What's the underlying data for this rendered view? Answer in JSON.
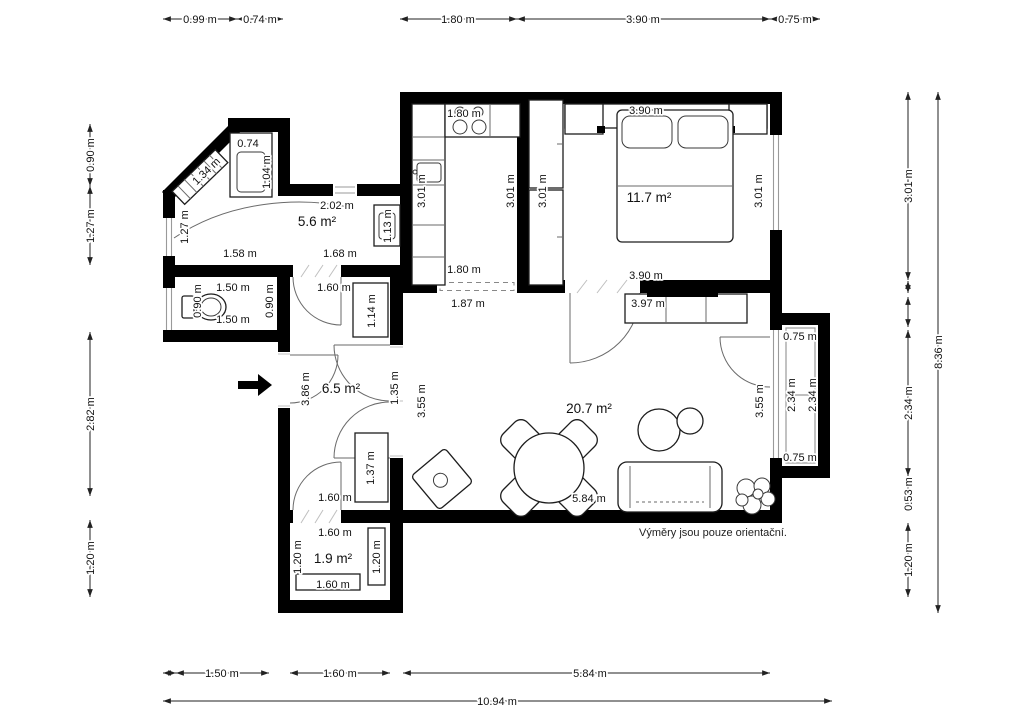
{
  "disclaimer": "Výměry jsou pouze orientační.",
  "colors": {
    "wall": "#000000",
    "background": "#ffffff",
    "furniture_line": "#1d1d1d",
    "dimension_text": "#111111"
  },
  "exterior_dims": {
    "top": [
      "0.99 m",
      "0.74 m",
      "1.80 m",
      "3.90 m",
      "0.75 m"
    ],
    "bottom": [
      "1.50 m",
      "1.60 m",
      "5.84 m",
      "10.94 m"
    ],
    "left": [
      "0.90 m",
      "1.27 m",
      "2.82 m",
      "1.20 m"
    ],
    "right": [
      "3.01 m",
      "2.34 m",
      "0.53 m",
      "1.20 m",
      "8.36 m"
    ]
  },
  "rooms": {
    "entry": {
      "area": "5.6 m²",
      "dims": {
        "closet_width": "0.74",
        "closet_depth": "1.04 m",
        "diagonal": "1.34 m",
        "left": "1.27 m",
        "top_wall": "2.02 m",
        "width_left": "1.58 m",
        "width_right": "1.68 m",
        "cabinet": "1.13 m"
      }
    },
    "wc": {
      "dims": {
        "width_top": "1.50 m",
        "depth_left": "0.90 m",
        "width_bottom": "1.50 m",
        "depth_right": "0.90 m"
      }
    },
    "kitchen": {
      "dims": {
        "width_top": "1.80 m",
        "depth_left": "3.01 m",
        "depth_right": "3.01 m",
        "width_bottom": "1.80 m",
        "opening": "1.87 m"
      }
    },
    "bedroom": {
      "area": "11.7 m²",
      "dims": {
        "width_top": "3.90 m",
        "wardrobe": "3.01 m",
        "depth_right": "3.01 m",
        "width_bottom": "3.90 m",
        "sideboard": "3.97 m"
      }
    },
    "hallway": {
      "area": "6.5 m²",
      "dims": {
        "door_top": "1.60 m",
        "cabinet_top": "1.14 m",
        "entry_door": "3.86 m",
        "double_door": "1.35 m",
        "cabinet_bottom": "1.37 m",
        "door_bottom": "1.60 m"
      }
    },
    "living": {
      "area": "20.7 m²",
      "dims": {
        "depth_left": "3.55 m",
        "depth_right": "3.55 m",
        "width": "5.84 m"
      }
    },
    "storage": {
      "area": "1.9 m²",
      "dims": {
        "width_top": "1.60 m",
        "depth_left": "1.20 m",
        "cabinet": "1.20 m",
        "width_bottom": "1.60 m"
      }
    },
    "balcony": {
      "dims": {
        "depth_top": "0.75 m",
        "length_outer": "2.34 m",
        "length_inner": "2.34 m",
        "depth_bottom": "0.75 m"
      }
    }
  }
}
